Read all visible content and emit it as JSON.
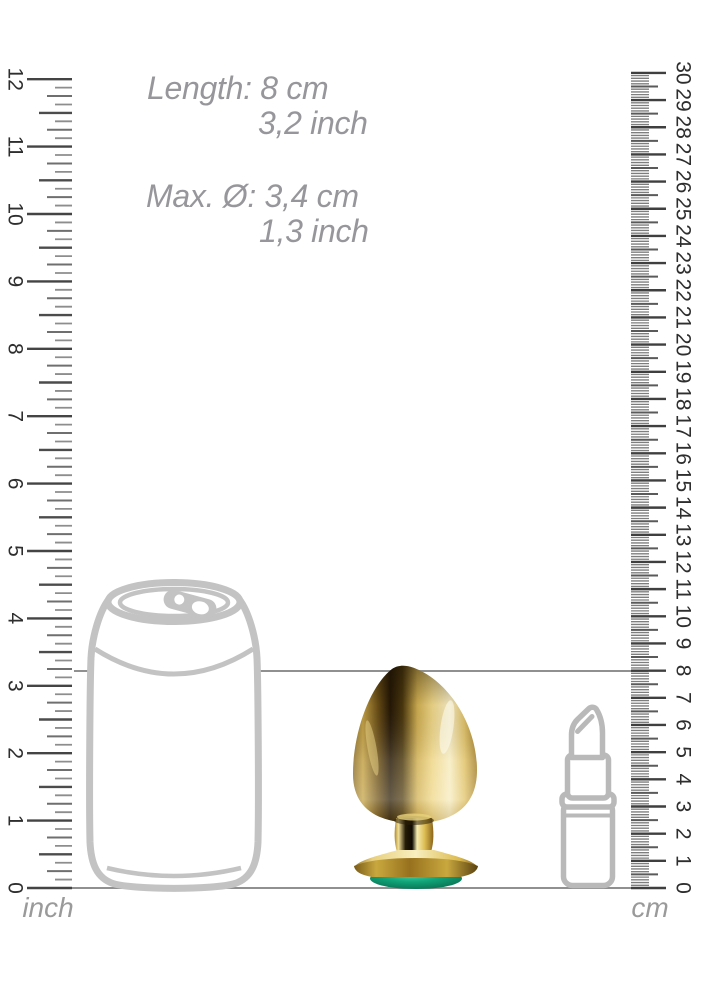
{
  "canvas": {
    "width": 704,
    "height": 1000,
    "background": "#ffffff"
  },
  "annotations": {
    "color": "#97979b",
    "font_size": 32,
    "lines": [
      {
        "id": "length-cm",
        "text": "Length: 8 cm",
        "x": 147,
        "y": 72
      },
      {
        "id": "length-inch",
        "text": "3,2 inch",
        "x": 258,
        "y": 107
      },
      {
        "id": "diameter-cm",
        "text": "Max. Ø: 3,4 cm",
        "x": 146,
        "y": 180
      },
      {
        "id": "diameter-inch",
        "text": "1,3 inch",
        "x": 259,
        "y": 215
      }
    ]
  },
  "rulers": {
    "inch": {
      "unit_label": "inch",
      "min": 0,
      "max": 12,
      "subdivisions_per_unit": 8,
      "zero_y": 888,
      "unit_px": 67.4,
      "edge_x": 72,
      "side": "left",
      "tick_lengths": {
        "unit": 45,
        "half": 33,
        "quarter": 25,
        "minor": 17
      },
      "tick_widths": {
        "unit": 2.4,
        "half": 2.4,
        "quarter": 2.0,
        "minor": 1.8
      },
      "tick_colors": {
        "unit": "#444444",
        "half": "#4c4c4c",
        "quarter": "#6f6f6f",
        "minor": "#8d8d8d"
      },
      "number_center_x": 15,
      "number_color": "#2e2e2e",
      "number_font_size": 21,
      "label_x": 48,
      "label_y": 917,
      "label_color": "#9a9a9a",
      "label_font_size": 28
    },
    "cm": {
      "unit_label": "cm",
      "min": 0,
      "max": 30,
      "subdivisions_per_unit": 10,
      "zero_y": 888,
      "unit_px": 27.17,
      "edge_x": 631,
      "side": "right",
      "tick_lengths": {
        "unit": 35,
        "half": 27,
        "minor": 18
      },
      "tick_widths": {
        "unit": 2.4,
        "half": 2.0,
        "minor": 1.35
      },
      "tick_colors": {
        "unit": "#3f3f3f",
        "half": "#5a5a5a",
        "minor": "#7e7e7e"
      },
      "number_center_x": 683,
      "number_color": "#2e2e2e",
      "number_font_size": 21,
      "label_x": 650,
      "label_y": 917,
      "label_color": "#9a9a9a",
      "label_font_size": 28
    }
  },
  "reference_lines": {
    "length_marker": {
      "y": 671,
      "x1": 74,
      "x2": 648,
      "color": "#909090",
      "width": 2
    },
    "baseline": {
      "y": 888,
      "x1": 72,
      "x2": 645,
      "color": "#909090",
      "width": 2
    }
  },
  "objects": {
    "can": {
      "outline_color": "#c3c3c3"
    },
    "lipstick": {
      "outline_color": "#b9b9b9"
    },
    "plug": {
      "gold_dark": "#241705",
      "gold_mid": "#c2a045",
      "gold_light": "#eed688",
      "gold_pale": "#f6ecc4",
      "gem_green": "#11a378",
      "gem_dark": "#07614a"
    }
  }
}
